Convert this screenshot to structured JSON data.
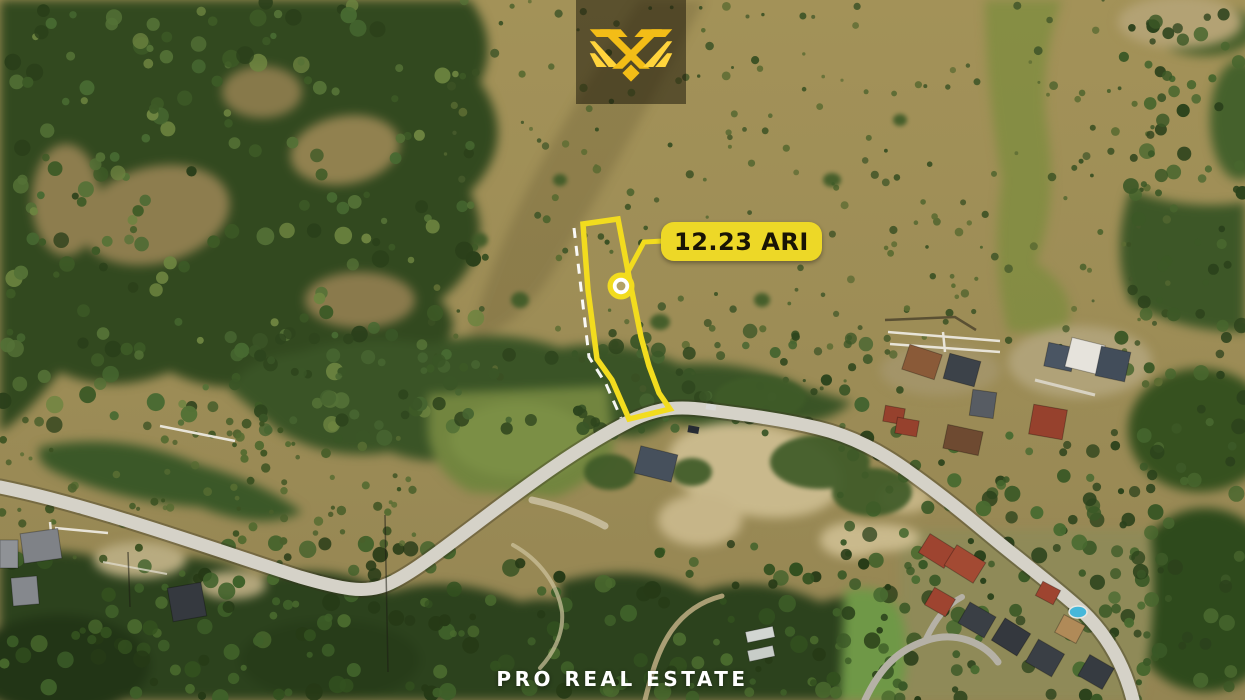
{
  "annotation": {
    "area_label": "12.23 ARI",
    "marker_icon": "plot-marker-icon"
  },
  "watermark": {
    "text": "PRO REAL ESTATE"
  },
  "logo": {
    "icon": "brand-monogram-icon"
  },
  "colors": {
    "accent": "#F2DC1E",
    "label_bg": "#EDD827",
    "label_text": "#191405",
    "dash": "#FFFFFF",
    "logo_gold": "#F3BD17",
    "logo_gold_light": "#FFD43C",
    "logo_bg": "rgba(24,21,7,0.52)",
    "watermark": "#FFFFFF"
  }
}
